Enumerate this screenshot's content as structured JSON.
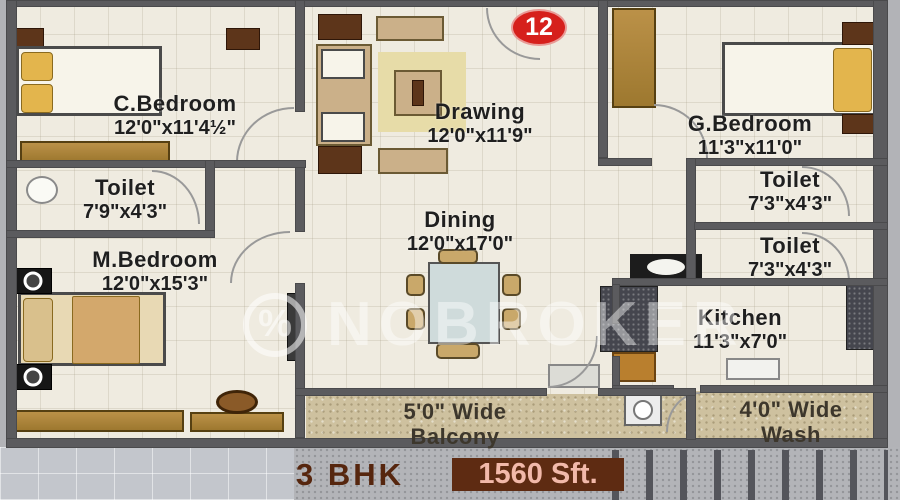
{
  "plan": {
    "unit_number": "12",
    "watermark": {
      "text": "NOBROKER",
      "symbol": "%"
    },
    "footer": {
      "bhk": "3 BHK",
      "area": "1560 Sft."
    },
    "rooms": {
      "c_bedroom": {
        "name": "C.Bedroom",
        "dims": "12'0\"x11'4½\""
      },
      "drawing": {
        "name": "Drawing",
        "dims": "12'0\"x11'9\""
      },
      "g_bedroom": {
        "name": "G.Bedroom",
        "dims": "11'3\"x11'0\""
      },
      "toilet_left": {
        "name": "Toilet",
        "dims": "7'9\"x4'3\""
      },
      "toilet_right_top": {
        "name": "Toilet",
        "dims": "7'3\"x4'3\""
      },
      "toilet_right_bottom": {
        "name": "Toilet",
        "dims": "7'3\"x4'3\""
      },
      "m_bedroom": {
        "name": "M.Bedroom",
        "dims": "12'0\"x15'3\""
      },
      "dining": {
        "name": "Dining",
        "dims": "12'0\"x17'0\""
      },
      "kitchen": {
        "name": "Kitchen",
        "dims": "11'3\"x7'0\""
      },
      "balcony": {
        "line1": "5'0\" Wide",
        "line2": "Balcony"
      },
      "wash": {
        "line1": "4'0\" Wide",
        "line2": "Wash"
      }
    },
    "colors": {
      "wall": "#5b5b5e",
      "floor": "#efebe0",
      "wood": "#b08a42",
      "badge_red": "#d6201c",
      "footer_brown": "#5e2b12",
      "footer_text": "#f2b9aa"
    }
  }
}
